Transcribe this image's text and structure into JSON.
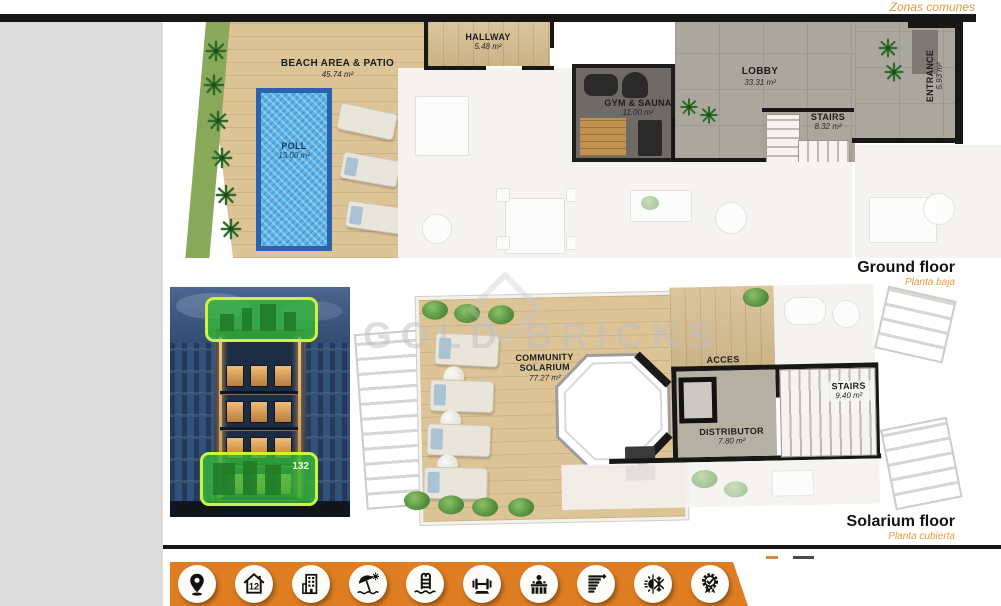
{
  "page": {
    "zonas_comunes": "Zonas comunes",
    "watermark": "GOLD BRICKS"
  },
  "ground_floor": {
    "title": "Ground floor",
    "subtitle": "Planta baja",
    "rooms": {
      "beach": {
        "name": "BEACH AREA & PATIO",
        "area": "45.74 m²"
      },
      "pool": {
        "name": "POLL",
        "area": "13.00 m²"
      },
      "hallway": {
        "name": "HALLWAY",
        "area": "5.48 m²"
      },
      "gym": {
        "name": "GYM & SAUNA",
        "area": "11.00 m²"
      },
      "lobby": {
        "name": "LOBBY",
        "area": "33.31 m²"
      },
      "stairs": {
        "name": "STAIRS",
        "area": "8.32 m²"
      },
      "entrance": {
        "name": "ENTRANCE",
        "area": "5.93 m²"
      }
    }
  },
  "solarium_floor": {
    "title": "Solarium floor",
    "subtitle": "Planta cubierta",
    "rooms": {
      "solarium": {
        "name": "COMMUNITY SOLARIUM",
        "area": "77.27 m²"
      },
      "acces": {
        "name": "ACCES"
      },
      "distributor": {
        "name": "DISTRIBUTOR",
        "area": "7.80 m²"
      },
      "stairs": {
        "name": "STAIRS",
        "area": "9.40 m²"
      }
    }
  },
  "building_photo": {
    "floor_badge": "132"
  },
  "footer": {
    "units_label": "12",
    "icons": [
      "location",
      "units-12",
      "residential-building",
      "beach-area",
      "swimming-pool",
      "gym",
      "reception",
      "energy-rating",
      "climate-control",
      "quality-certificate"
    ]
  },
  "colors": {
    "accent_orange": "#de7d22",
    "label_orange": "#e59b3c",
    "highlight_green": "#34ba38",
    "pool_blue": "#5fb6e6"
  }
}
